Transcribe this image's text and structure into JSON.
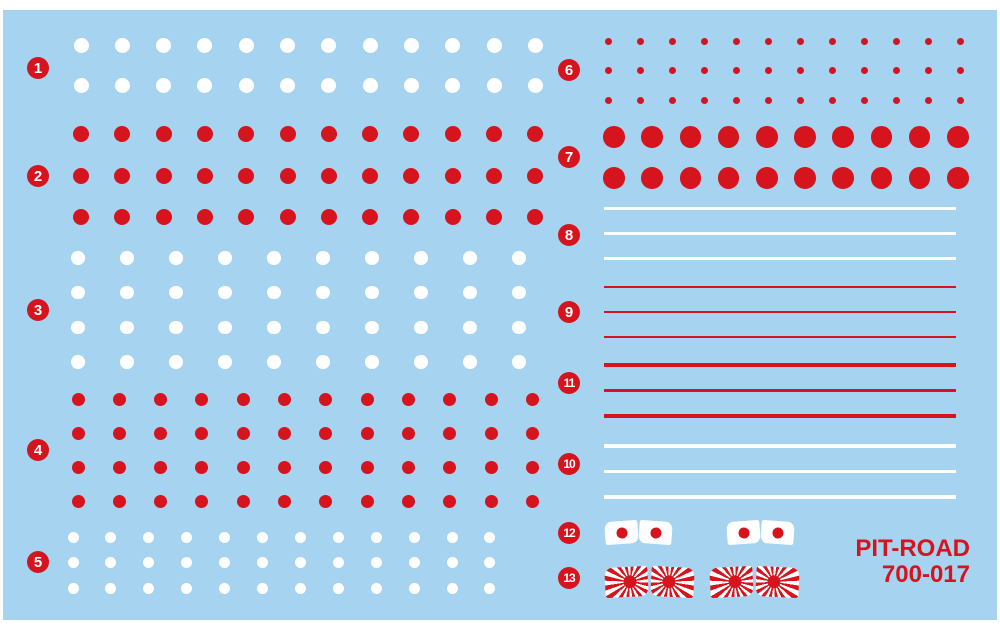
{
  "sheet": {
    "colors": {
      "background_blue": "#a5d3f0",
      "decal_red": "#d6141e",
      "decal_white": "#ffffff"
    },
    "brand": {
      "name": "PIT-ROAD",
      "code": "700-017"
    },
    "groups": [
      {
        "label": "1",
        "type": "dots",
        "color_key": "decal_white",
        "badge": {
          "x": 38,
          "y": 68
        },
        "grid": {
          "x": 81,
          "y": 45,
          "cols": 12,
          "rows": 2,
          "dx": 41.3,
          "dy": 40,
          "d": 15
        }
      },
      {
        "label": "2",
        "type": "dots",
        "color_key": "decal_red",
        "badge": {
          "x": 38,
          "y": 176
        },
        "grid": {
          "x": 81,
          "y": 134,
          "cols": 12,
          "rows": 3,
          "dx": 41.3,
          "dy": 41.5,
          "d": 16
        }
      },
      {
        "label": "3",
        "type": "dots",
        "color_key": "decal_white",
        "badge": {
          "x": 38,
          "y": 310
        },
        "grid": {
          "x": 78,
          "y": 258,
          "cols": 10,
          "rows": 4,
          "dx": 49,
          "dy": 34.7,
          "d": 13.5
        }
      },
      {
        "label": "4",
        "type": "dots",
        "color_key": "decal_red",
        "badge": {
          "x": 38,
          "y": 450
        },
        "grid": {
          "x": 78,
          "y": 399,
          "cols": 12,
          "rows": 4,
          "dx": 41.3,
          "dy": 34.3,
          "d": 13
        }
      },
      {
        "label": "5",
        "type": "dots",
        "color_key": "decal_white",
        "badge": {
          "x": 38,
          "y": 562
        },
        "grid": {
          "x": 73,
          "y": 537,
          "cols": 12,
          "rows": 3,
          "dx": 37.9,
          "dy": 25.5,
          "d": 11
        }
      },
      {
        "label": "6",
        "type": "dots",
        "color_key": "decal_red",
        "badge": {
          "x": 569,
          "y": 70
        },
        "grid": {
          "x": 608,
          "y": 41,
          "cols": 12,
          "rows": 3,
          "dx": 32,
          "dy": 29.5,
          "d": 7
        }
      },
      {
        "label": "7",
        "type": "dots",
        "color_key": "decal_red",
        "badge": {
          "x": 569,
          "y": 157
        },
        "grid": {
          "x": 614,
          "y": 137,
          "cols": 10,
          "rows": 2,
          "dx": 38.2,
          "dy": 41,
          "d": 21.5
        }
      },
      {
        "label": "8",
        "type": "stripes",
        "color_key": "decal_white",
        "badge": {
          "x": 569,
          "y": 235
        },
        "stripes": {
          "x": 604,
          "w": 352,
          "y": 208,
          "dy": 25.2,
          "t": 3,
          "count": 3
        }
      },
      {
        "label": "9",
        "type": "stripes",
        "color_key": "decal_red",
        "badge": {
          "x": 569,
          "y": 312
        },
        "stripes": {
          "x": 604,
          "w": 352,
          "y": 287,
          "dy": 25,
          "t": 2.5,
          "count": 3
        }
      },
      {
        "label": "11",
        "type": "stripes",
        "color_key": "decal_red",
        "badge": {
          "x": 569,
          "y": 383
        },
        "stripes": {
          "x": 604,
          "w": 352,
          "y": 365,
          "dy": 25.5,
          "t": 3.5,
          "count": 3
        }
      },
      {
        "label": "10",
        "type": "stripes",
        "color_key": "decal_white",
        "badge": {
          "x": 569,
          "y": 464
        },
        "stripes": {
          "x": 604,
          "w": 352,
          "y": 446,
          "dy": 25.5,
          "t": 3.5,
          "count": 3
        }
      },
      {
        "label": "12",
        "type": "hinomaru-flags",
        "badge": {
          "x": 569,
          "y": 533
        },
        "flag_w": 33,
        "flag_h": 23,
        "sun_d": 11,
        "flags": [
          {
            "x": 605,
            "y": 521
          },
          {
            "x": 639,
            "y": 521
          },
          {
            "x": 727,
            "y": 521
          },
          {
            "x": 761,
            "y": 521
          }
        ]
      },
      {
        "label": "13",
        "type": "risingsun-flags",
        "badge": {
          "x": 569,
          "y": 578
        },
        "flag_w": 43,
        "flag_h": 30,
        "sun_d": 13,
        "flags": [
          {
            "x": 605,
            "y": 567
          },
          {
            "x": 651,
            "y": 567
          },
          {
            "x": 710,
            "y": 567
          },
          {
            "x": 756,
            "y": 567
          }
        ]
      }
    ]
  }
}
